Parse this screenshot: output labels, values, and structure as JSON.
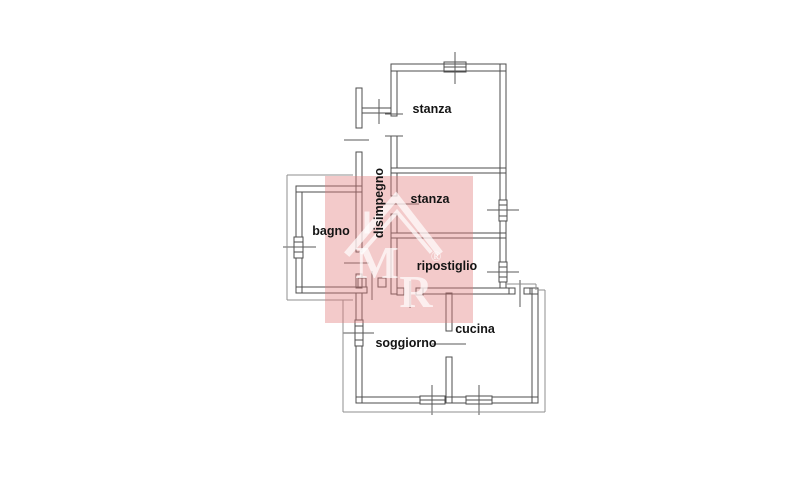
{
  "canvas": {
    "background": "#ffffff",
    "line_color": "#4d4d4d",
    "tick_color": "#5a5a5a",
    "thin_line_color": "#8f8f8f",
    "text_color": "#141414"
  },
  "rooms": {
    "stanza_top": {
      "label": "stanza"
    },
    "stanza_mid": {
      "label": "stanza"
    },
    "disimpegno": {
      "label": "disimpegno"
    },
    "bagno": {
      "label": "bagno"
    },
    "ripostiglio": {
      "label": "ripostiglio"
    },
    "soggiorno": {
      "label": "soggiorno"
    },
    "cucina": {
      "label": "cucina"
    }
  },
  "watermark": {
    "letter_m": "M",
    "letter_r": "R",
    "registered_symbol": "®",
    "background_color": "rgba(224,122,122,0.40)",
    "glyph_color": "rgba(255,255,255,0.70)"
  }
}
